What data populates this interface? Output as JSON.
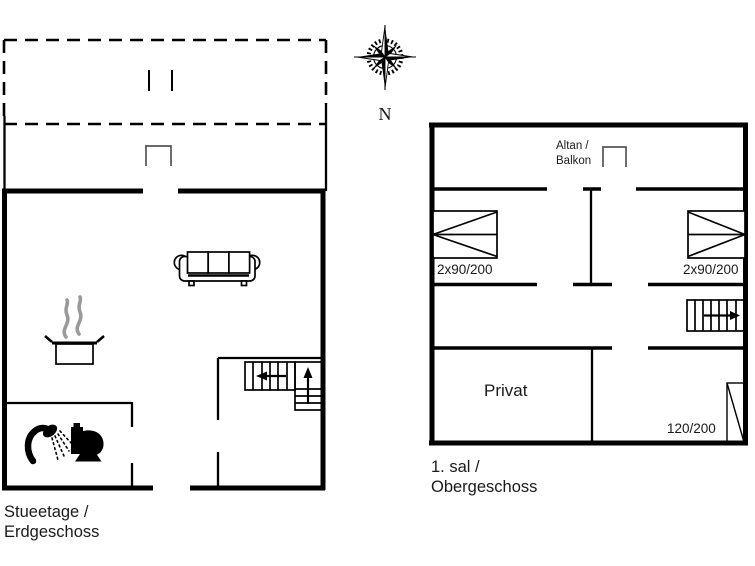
{
  "compass": {
    "north_label": "N"
  },
  "ground_floor": {
    "caption_line1": "Stueetage /",
    "caption_line2": "Erdgeschoss"
  },
  "upper_floor": {
    "caption_line1": "1. sal /",
    "caption_line2": "Obergeschoss",
    "balcony_line1": "Altan /",
    "balcony_line2": "Balkon",
    "bed_left_label": "2x90/200",
    "bed_right_label": "2x90/200",
    "private_room_label": "Privat",
    "bed_single_label": "120/200"
  },
  "colors": {
    "wall": "#000000",
    "text": "#1a1a1a",
    "door_symbol": "#555555",
    "steam": "#9a9a9a",
    "background": "#ffffff"
  }
}
